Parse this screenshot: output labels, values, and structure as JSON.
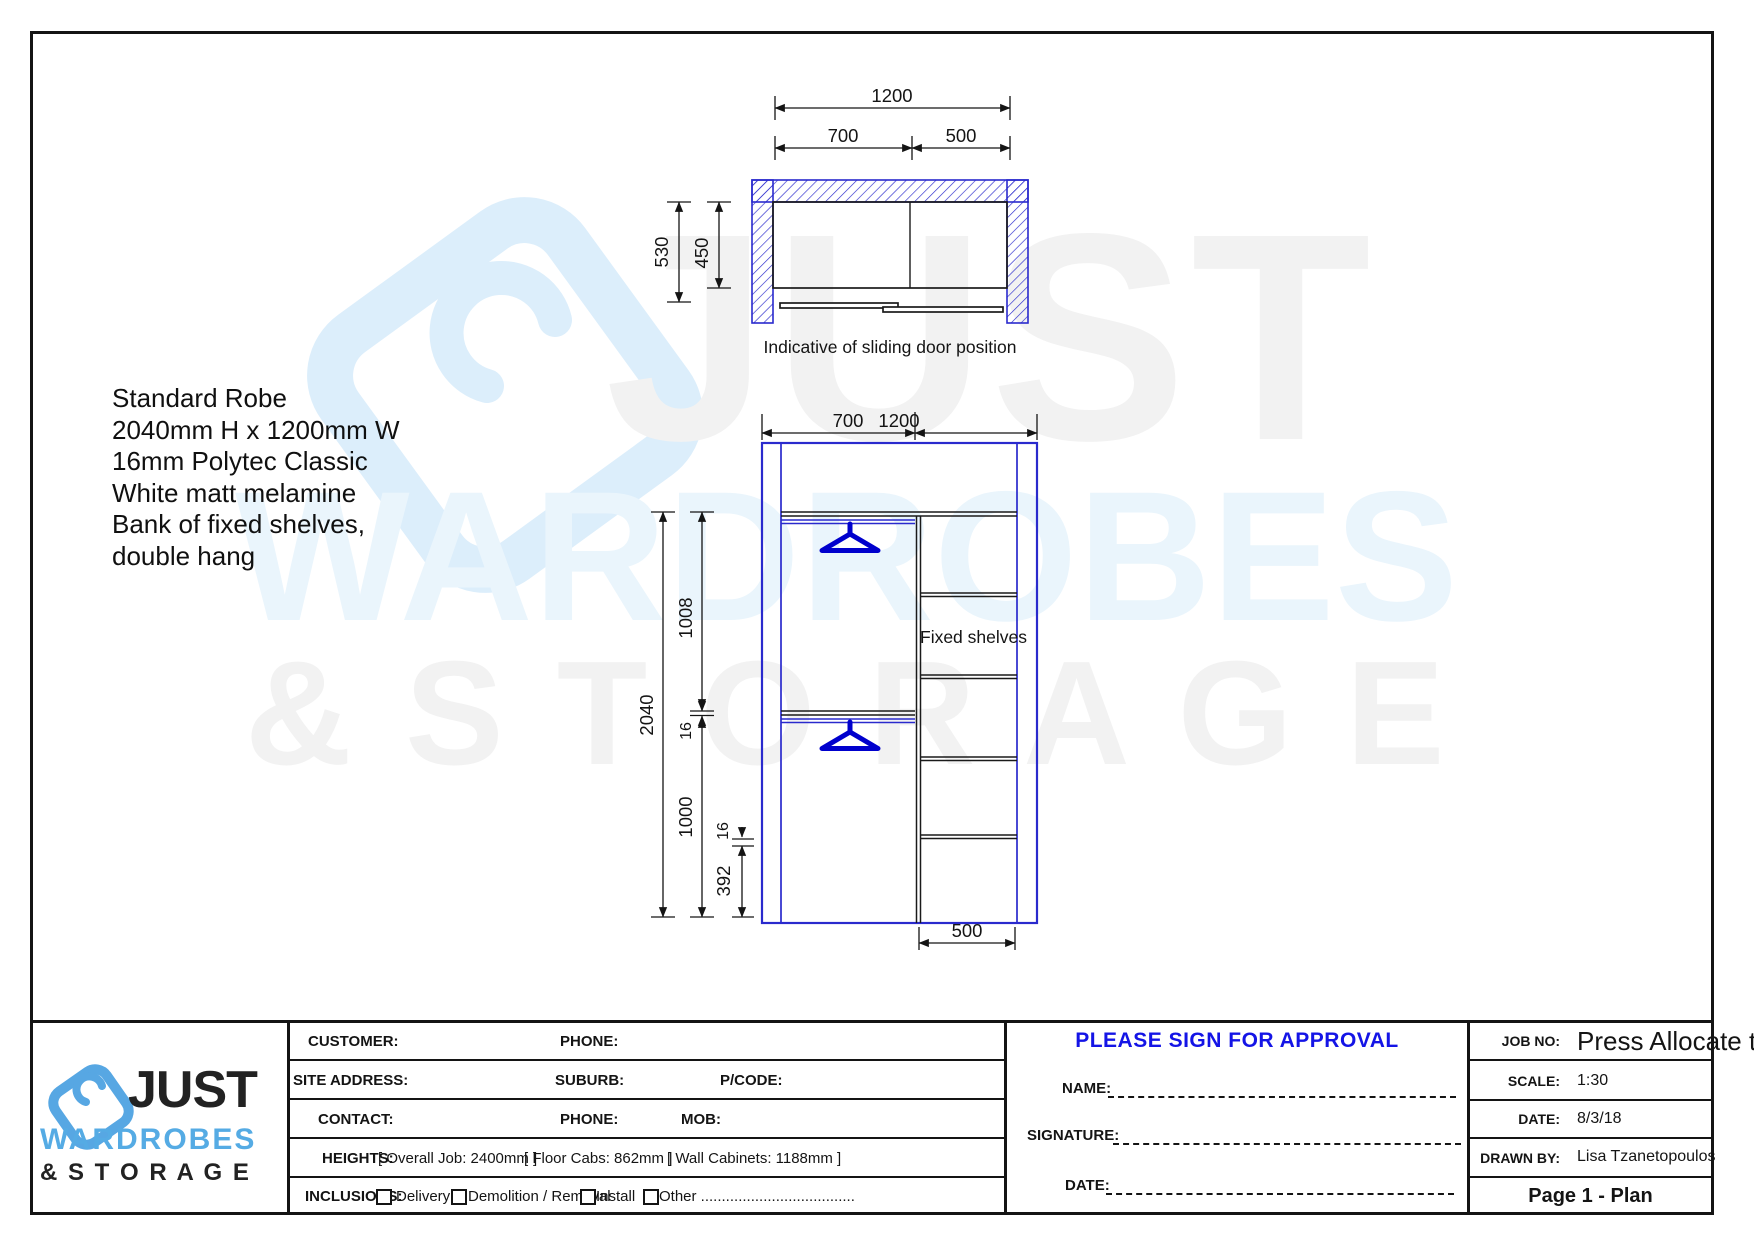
{
  "colors": {
    "drawing_blue": "#2a2acd",
    "hanger_blue": "#0000cd",
    "approval_blue": "#1414e6",
    "logo_blue": "#57a7e3",
    "watermark_gray": "#f2f2f2",
    "watermark_blue": "#eaf5fc"
  },
  "watermark": {
    "word1": "JUST",
    "word2": "WARDROBES",
    "word3": "& S T O R A G E"
  },
  "spec_note": {
    "lines": [
      "Standard Robe",
      "2040mm H x 1200mm W",
      "16mm Polytec Classic",
      "White matt melamine",
      "Bank of fixed shelves,",
      "double hang"
    ]
  },
  "plan": {
    "dim_overall": "1200",
    "dim_left": "700",
    "dim_right": "500",
    "dim_depth_outer": "530",
    "dim_depth_inner": "450",
    "caption": "Indicative of sliding door position"
  },
  "elevation": {
    "dim_left": "700",
    "dim_overall": "1200",
    "dim_height": "2040",
    "dim_upper": "1008",
    "dim_mid_16": "16",
    "dim_lower": "1000",
    "dim_low_16": "16",
    "dim_plinth": "392",
    "dim_shelf_width": "500",
    "fixed_shelves_label": "Fixed shelves"
  },
  "title_block": {
    "logo": {
      "just": "JUST",
      "wardrobes": "WARDROBES",
      "storage": "& S T O R A G E"
    },
    "fields": {
      "customer": "CUSTOMER:",
      "phone_top": "PHONE:",
      "site_address": "SITE ADDRESS:",
      "suburb": "SUBURB:",
      "pcode": "P/CODE:",
      "contact": "CONTACT:",
      "phone_mid": "PHONE:",
      "mob": "MOB:"
    },
    "heights": {
      "label": "HEIGHTS:",
      "overall": "[ Overall Job: 2400mm ]",
      "floor": "[ Floor Cabs: 862mm ]",
      "wall": "[ Wall Cabinets: 1188mm ]"
    },
    "inclusions": {
      "label": "INCLUSIONS:",
      "delivery": "Delivery",
      "demolition": "Demolition / Removal",
      "install": "Install",
      "other": "Other ....................................."
    },
    "approval": {
      "heading": "PLEASE SIGN FOR APPROVAL",
      "name_label": "NAME:",
      "signature_label": "SIGNATURE:",
      "date_label": "DATE:"
    },
    "info": {
      "job_no_label": "JOB NO:",
      "job_no_value": "Press Allocate to a",
      "scale_label": "SCALE:",
      "scale_value": "1:30",
      "date_label": "DATE:",
      "date_value": "8/3/18",
      "drawn_by_label": "DRAWN BY:",
      "drawn_by_value": "Lisa Tzanetopoulos",
      "page_label": "Page 1 - Plan"
    }
  }
}
